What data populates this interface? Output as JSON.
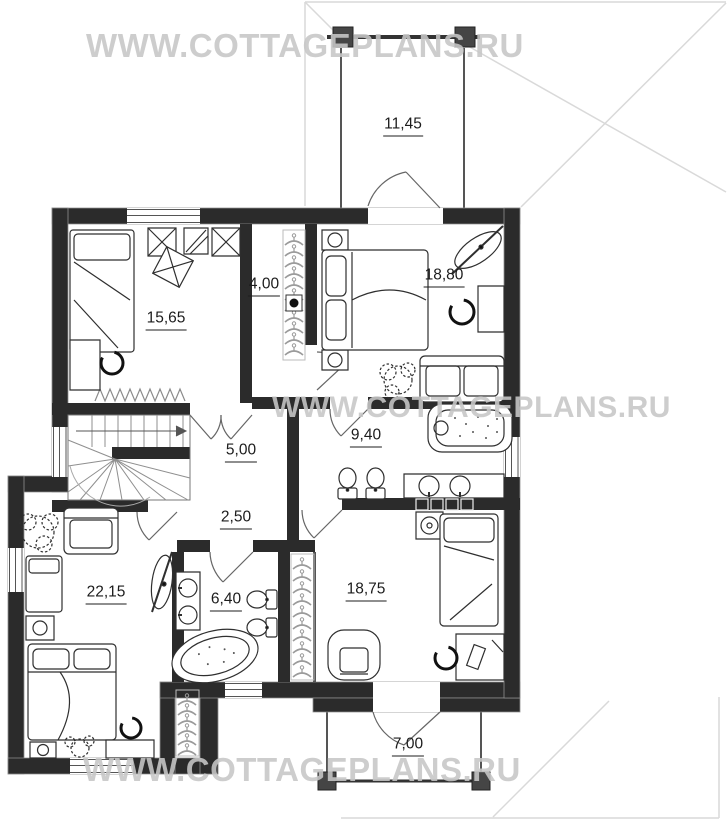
{
  "plan": {
    "watermark_text": "WWW.COTTAGEPLANS.RU",
    "rooms": [
      {
        "room": "balcony-top",
        "area": "11,45"
      },
      {
        "room": "kids-bedroom",
        "area": "15,65"
      },
      {
        "room": "walk-in-closet",
        "area": "4,00"
      },
      {
        "room": "master-bedroom",
        "area": "18,80"
      },
      {
        "room": "hall",
        "area": "5,00"
      },
      {
        "room": "master-bathroom",
        "area": "9,40"
      },
      {
        "room": "corridor",
        "area": "2,50"
      },
      {
        "room": "bedroom-left",
        "area": "22,15"
      },
      {
        "room": "bathroom",
        "area": "6,40"
      },
      {
        "room": "study-bedroom",
        "area": "18,75"
      },
      {
        "room": "terrace-bottom",
        "area": "7,00"
      }
    ],
    "colors": {
      "wall": "#2b2b2b",
      "column": "#454545",
      "roofline": "#d9d9d9",
      "watermark": "#c7c7c7",
      "label": "#1c1c1c"
    }
  }
}
